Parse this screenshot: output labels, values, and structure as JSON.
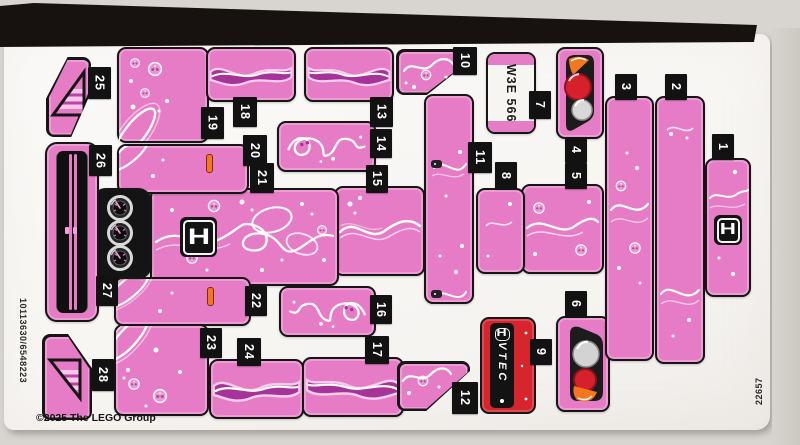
{
  "sheet": {
    "copyright": "©2025 The LEGO Group",
    "serial_left": "10113630/6548223",
    "serial_right": "22657"
  },
  "stickers": {
    "tags": [
      "1",
      "2",
      "3",
      "4",
      "5",
      "6",
      "7",
      "8",
      "9",
      "10",
      "11",
      "12",
      "13",
      "14",
      "15",
      "16",
      "17",
      "18",
      "19",
      "20",
      "21",
      "22",
      "23",
      "24",
      "25",
      "26",
      "27",
      "28"
    ],
    "license_plate_text": "W3E 566",
    "vtec_text": "VTEC",
    "honda_letter": "H"
  },
  "colors": {
    "sticker_pink": "#e77cc6",
    "graphic_magenta": "#a63397",
    "vtec_red": "#d7252e",
    "light_red": "#d6202b",
    "indicator_orange": "#f4761f",
    "outline_black": "#161616"
  }
}
